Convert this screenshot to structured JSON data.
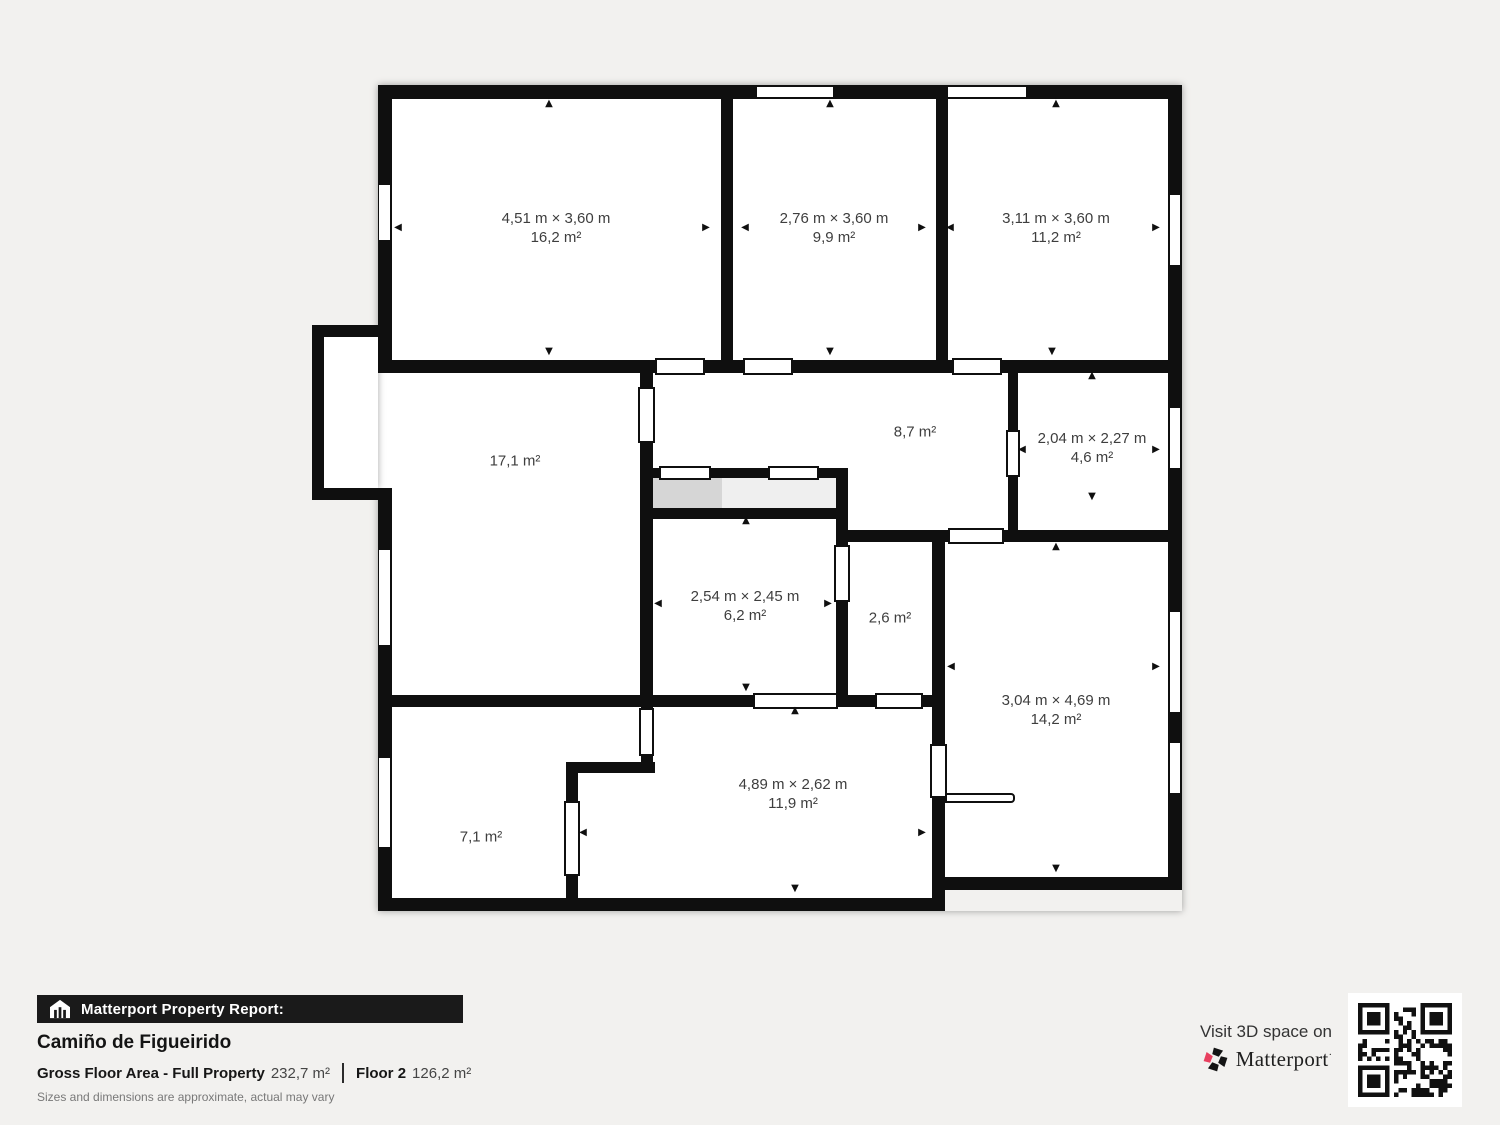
{
  "floorplan": {
    "rooms": [
      {
        "id": "16_2",
        "dimensions": "4,51 m × 3,60 m",
        "area": "16,2 m²"
      },
      {
        "id": "9_9",
        "dimensions": "2,76 m × 3,60 m",
        "area": "9,9 m²"
      },
      {
        "id": "11_2",
        "dimensions": "3,11 m × 3,60 m",
        "area": "11,2 m²"
      },
      {
        "id": "17_1",
        "dimensions": null,
        "area": "17,1 m²"
      },
      {
        "id": "8_7",
        "dimensions": null,
        "area": "8,7 m²"
      },
      {
        "id": "4_6",
        "dimensions": "2,04 m × 2,27 m",
        "area": "4,6 m²"
      },
      {
        "id": "6_2",
        "dimensions": "2,54 m × 2,45 m",
        "area": "6,2 m²"
      },
      {
        "id": "2_6",
        "dimensions": null,
        "area": "2,6 m²"
      },
      {
        "id": "14_2",
        "dimensions": "3,04 m × 4,69 m",
        "area": "14,2 m²"
      },
      {
        "id": "11_9",
        "dimensions": "4,89 m × 2,62 m",
        "area": "11,9 m²"
      },
      {
        "id": "7_1",
        "dimensions": null,
        "area": "7,1 m²"
      }
    ]
  },
  "report": {
    "brand_bar": "Matterport Property Report:",
    "property_name": "Camiño de Figueirido",
    "gfa_label": "Gross Floor Area - Full Property",
    "gfa_value": "232,7 m²",
    "floor_label": "Floor 2",
    "floor_value": "126,2 m²",
    "disclaimer": "Sizes and dimensions are approximate, actual may vary"
  },
  "cta": {
    "visit_text": "Visit 3D space on",
    "brand": "Matterport",
    "trademark": "·"
  },
  "colors": {
    "wall": "#0f0f0f",
    "background": "#f2f1ef",
    "label_text": "#3e3e3e",
    "brand_bar_bg": "#1a1a1a",
    "accent_red": "#e8405f",
    "closet_dark": "#d6d6d6",
    "closet_light": "#efefef"
  }
}
